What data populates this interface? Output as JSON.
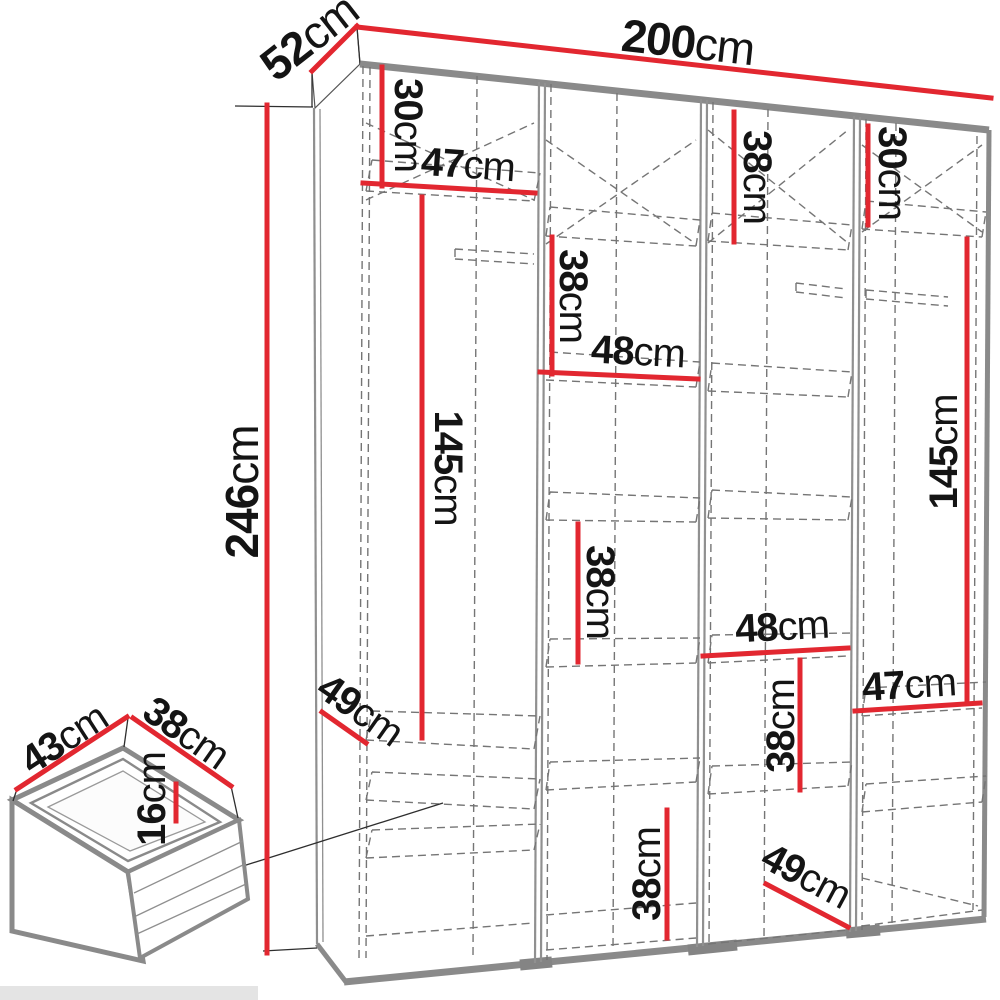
{
  "unit": "cm",
  "colors": {
    "dimension_red": "#e22730",
    "edge_gray": "#8a8a8a",
    "dash_gray": "#757575",
    "text_black": "#141414"
  },
  "overall": {
    "width": {
      "num": "200",
      "unit": "cm"
    },
    "depth": {
      "num": "52",
      "unit": "cm"
    },
    "height": {
      "num": "246",
      "unit": "cm"
    }
  },
  "section1": {
    "top_height": {
      "num": "30",
      "unit": "cm"
    },
    "shelf_width": {
      "num": "47",
      "unit": "cm"
    },
    "hanging_height": {
      "num": "145",
      "unit": "cm"
    },
    "bottom_depth": {
      "num": "49",
      "unit": "cm"
    }
  },
  "section2": {
    "upper_height": {
      "num": "38",
      "unit": "cm"
    },
    "shelf_width": {
      "num": "48",
      "unit": "cm"
    },
    "middle_height": {
      "num": "38",
      "unit": "cm"
    },
    "bottom_height": {
      "num": "38",
      "unit": "cm"
    }
  },
  "section3": {
    "top_height": {
      "num": "38",
      "unit": "cm"
    },
    "shelf_width": {
      "num": "48",
      "unit": "cm"
    },
    "lower_height": {
      "num": "38",
      "unit": "cm"
    },
    "bottom_depth": {
      "num": "49",
      "unit": "cm"
    }
  },
  "section4": {
    "top_height": {
      "num": "30",
      "unit": "cm"
    },
    "hanging_height": {
      "num": "145",
      "unit": "cm"
    },
    "shelf_width": {
      "num": "47",
      "unit": "cm"
    }
  },
  "drawer": {
    "width": {
      "num": "43",
      "unit": "cm"
    },
    "depth": {
      "num": "38",
      "unit": "cm"
    },
    "height": {
      "num": "16",
      "unit": "cm"
    }
  }
}
